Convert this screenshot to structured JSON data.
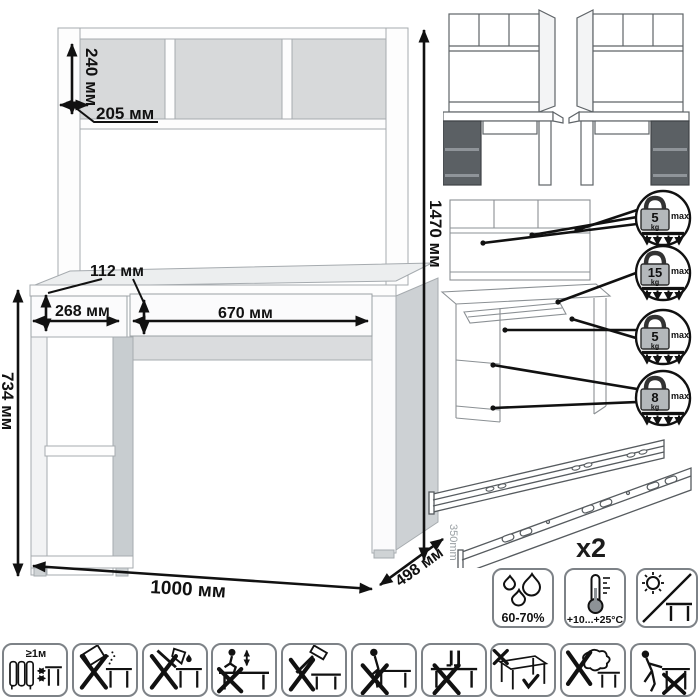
{
  "main_diagram": {
    "dims": {
      "shelf_height": "240 мм",
      "shelf_depth": "205 мм",
      "total_height": "1470 мм",
      "drawer_height": "112 мм",
      "drawer_left_width": "268 мм",
      "drawer_right_width": "670 мм",
      "desk_height": "734 мм",
      "width": "1000 мм",
      "depth": "498 мм"
    }
  },
  "variant_icons": [
    {
      "name": "desk-variant-left-pedestal-icon"
    },
    {
      "name": "desk-variant-right-pedestal-icon"
    }
  ],
  "load_limits": [
    {
      "icon": "weight-icon",
      "value": "5",
      "unit": "kg",
      "max": "max"
    },
    {
      "icon": "weight-icon",
      "value": "15",
      "unit": "kg",
      "max": "max"
    },
    {
      "icon": "weight-icon",
      "value": "5",
      "unit": "kg",
      "max": "max"
    },
    {
      "icon": "weight-icon",
      "value": "8",
      "unit": "kg",
      "max": "max"
    }
  ],
  "hardware": {
    "rail_length": "350mm",
    "rail_count": "x2"
  },
  "environment_icons": [
    {
      "name": "humidity-icon",
      "label": "60-70%"
    },
    {
      "name": "temperature-icon",
      "label": "+10...+25°C"
    },
    {
      "name": "no-direct-sunlight-icon",
      "label": ""
    }
  ],
  "care_icons": [
    {
      "name": "heater-distance-icon",
      "label": "≥1м"
    },
    {
      "name": "no-abrasive-spill-icon",
      "label": ""
    },
    {
      "name": "no-sharp-tools-icon",
      "label": ""
    },
    {
      "name": "no-jumping-icon",
      "label": ""
    },
    {
      "name": "no-hammering-icon",
      "label": ""
    },
    {
      "name": "no-sitting-icon",
      "label": ""
    },
    {
      "name": "no-standing-icon",
      "label": ""
    },
    {
      "name": "carry-properly-icon",
      "label": ""
    },
    {
      "name": "no-wet-cloth-icon",
      "label": ""
    },
    {
      "name": "no-dragging-icon",
      "label": ""
    }
  ],
  "colors": {
    "dimension": "#111111",
    "panel_white": "#fdfdfd",
    "interior_gray": "#d7d9da",
    "side_gray": "#c8cdd0",
    "dark_pedestal": "#5b6064"
  }
}
